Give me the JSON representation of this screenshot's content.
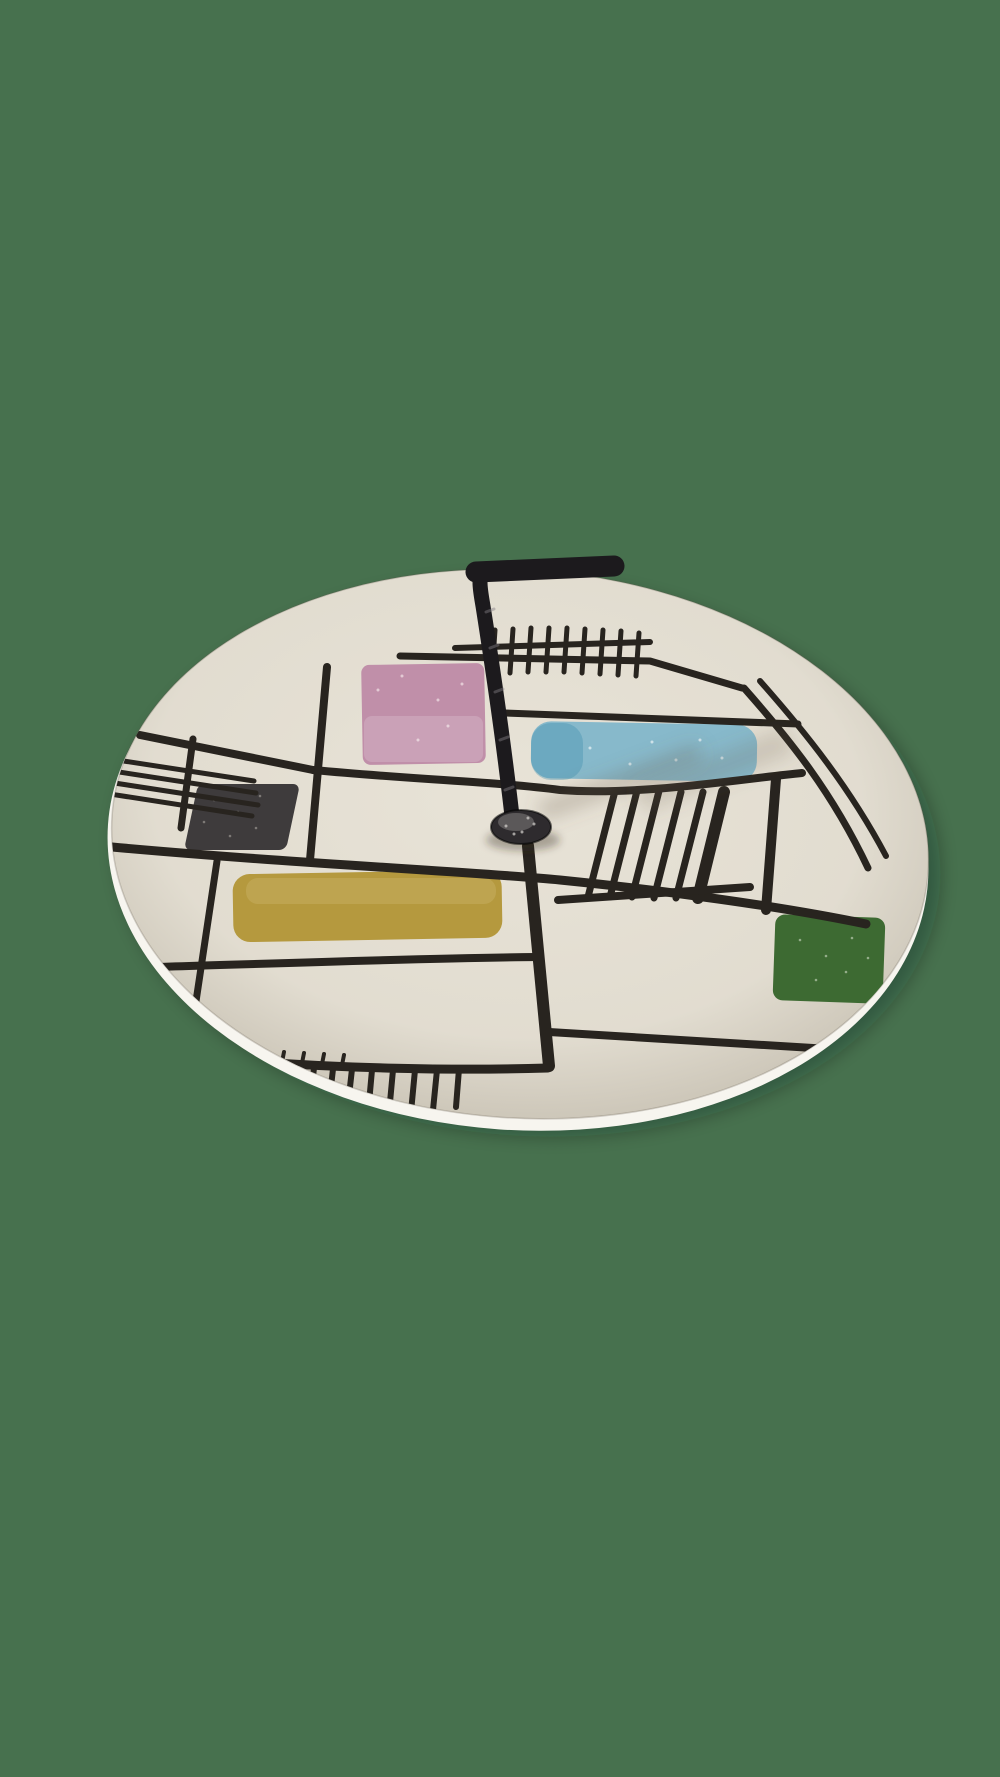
{
  "scene": {
    "type": "photograph",
    "subject": "Vintage mid-century ceramic serving plate (cake stand) with central black metal handle",
    "description": "Round cream ceramic plate photographed at an angle on a plain muted-green backdrop. The glaze is hand-painted with an abstract Mondrian-style grid of irregular black lines, ladder/comb hatching at the top edge and bottom edge, a group of slanted vertical bars at the right, and five colored rectangles. A twisted black wrought-iron handle rises from a domed metal fitting at the center and bends to a horizontal grip at the top.",
    "style": "1950s abstract pottery"
  },
  "background": {
    "color": "#47714e"
  },
  "plate": {
    "surface_color": "#e8e3d7",
    "rim_highlight_color": "#f7f5ef",
    "pattern_line_color": "#28241f",
    "shape": "ellipse (circle in perspective)",
    "decoration": "black hand-painted grid lines, top comb hatch, bottom fringe comb, five slanted vertical bars, multi-line hatch at left rim, double diagonal lines at right rim"
  },
  "patches": [
    {
      "name": "pink-rectangle",
      "color": "#c08fa9",
      "position": "upper area, left of handle"
    },
    {
      "name": "blue-rectangle",
      "color": "#87b9cb",
      "position": "upper right of handle"
    },
    {
      "name": "grey-rectangle",
      "color": "#3e3b3c",
      "position": "left side"
    },
    {
      "name": "yellow-rectangle",
      "color": "#b5993e",
      "position": "lower left, wide swatch"
    },
    {
      "name": "green-rectangle",
      "color": "#3d6a32",
      "position": "lower right near rim"
    }
  ],
  "handle": {
    "color": "#1c1a1d",
    "knob_color": "#2e2b2e",
    "material": "twisted wrought iron",
    "shape": "vertical stem bending to a horizontal top grip extending right"
  }
}
